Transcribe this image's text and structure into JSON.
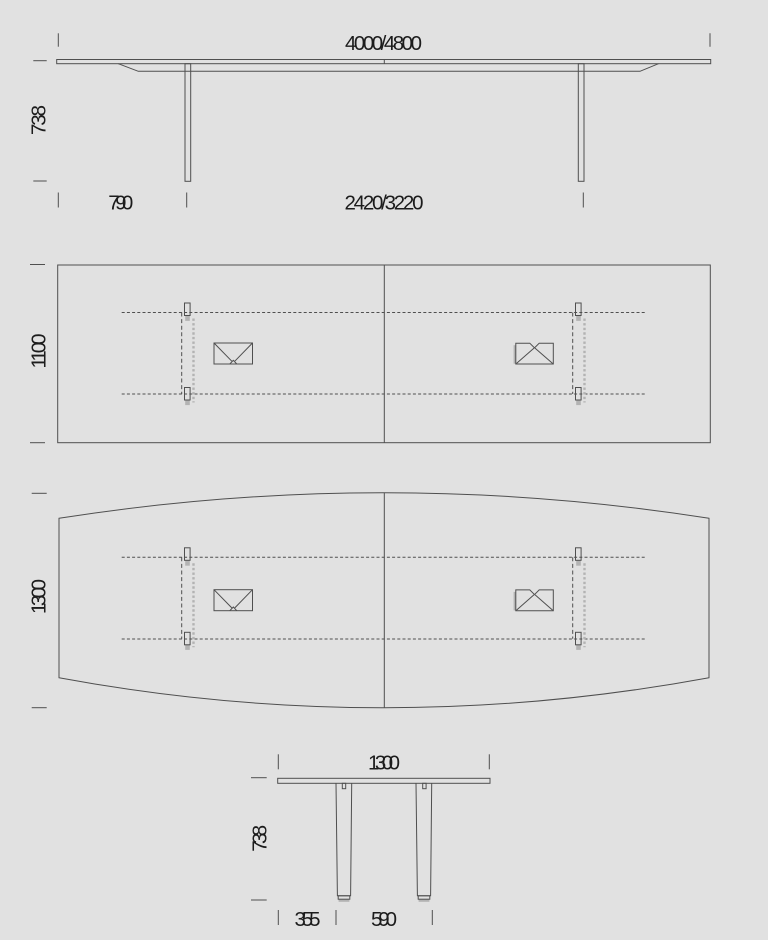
{
  "canvas": {
    "background": "#e1e1e1",
    "line_color": "#4f4f4f",
    "shadow_gray": "#b3b3b3",
    "text_color": "#1c1c1c"
  },
  "views": {
    "side_elevation": {
      "length": "4000/4800",
      "height": "738",
      "end_overhang": "790",
      "leg_spacing": "2420/3220"
    },
    "top_view_rectangular": {
      "depth": "1100"
    },
    "top_view_barrel": {
      "depth": "1300"
    },
    "end_elevation": {
      "width": "1300",
      "height": "738",
      "edge_to_leg": "355",
      "leg_spacing": "590"
    }
  }
}
